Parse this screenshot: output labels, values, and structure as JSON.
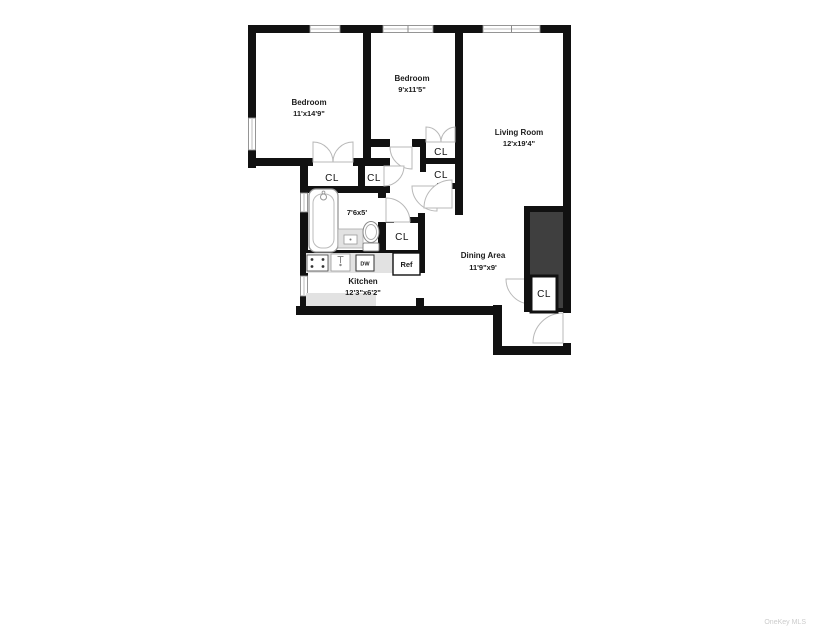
{
  "page": {
    "watermark": "OneKey MLS",
    "background_color": "#ffffff"
  },
  "floorplan": {
    "wall_color": "#111111",
    "shaft_color": "#3f3f3f",
    "counter_color": "#e2e2e2",
    "rooms": [
      {
        "id": "bedroom-1",
        "name": "Bedroom",
        "dims": "11'x14'9\""
      },
      {
        "id": "bedroom-2",
        "name": "Bedroom",
        "dims": "9'x11'5\""
      },
      {
        "id": "living-room",
        "name": "Living Room",
        "dims": "12'x19'4\""
      },
      {
        "id": "bathroom",
        "name": "",
        "dims": "7'6x5'"
      },
      {
        "id": "kitchen",
        "name": "Kitchen",
        "dims": "12'3\"x6'2\""
      },
      {
        "id": "dining-area",
        "name": "Dining Area",
        "dims": "11'9\"x9'"
      }
    ],
    "closets": [
      {
        "id": "closet-bedroom-1",
        "label": "CL"
      },
      {
        "id": "closet-hall-small",
        "label": "CL"
      },
      {
        "id": "closet-bedroom-2-top",
        "label": "CL"
      },
      {
        "id": "closet-bedroom-2-bottom",
        "label": "CL"
      },
      {
        "id": "closet-hall",
        "label": "CL"
      },
      {
        "id": "closet-entry",
        "label": "CL"
      }
    ],
    "appliances": [
      {
        "id": "dishwasher",
        "label": "DW"
      },
      {
        "id": "refrigerator",
        "label": "Ref"
      }
    ]
  }
}
